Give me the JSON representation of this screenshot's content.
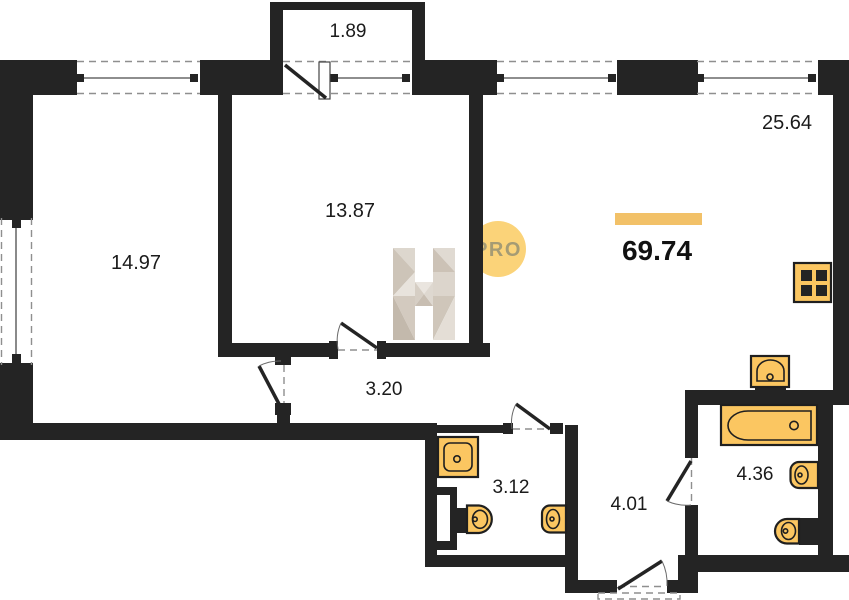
{
  "areas": {
    "balcony": "1.89",
    "room_left": "14.97",
    "room_middle": "13.87",
    "living_kitchen": "25.64",
    "hallway": "3.20",
    "shower_room": "3.12",
    "entry_hall": "4.01",
    "bathroom": "4.36",
    "total": "69.74"
  },
  "watermark": {
    "badge": "PRO"
  },
  "colors": {
    "wall": "#242424",
    "fixture": "#fbc661",
    "accent_bar": "#f2c168",
    "badge_bg": "#fbd379",
    "badge_text": "#a59b74"
  }
}
